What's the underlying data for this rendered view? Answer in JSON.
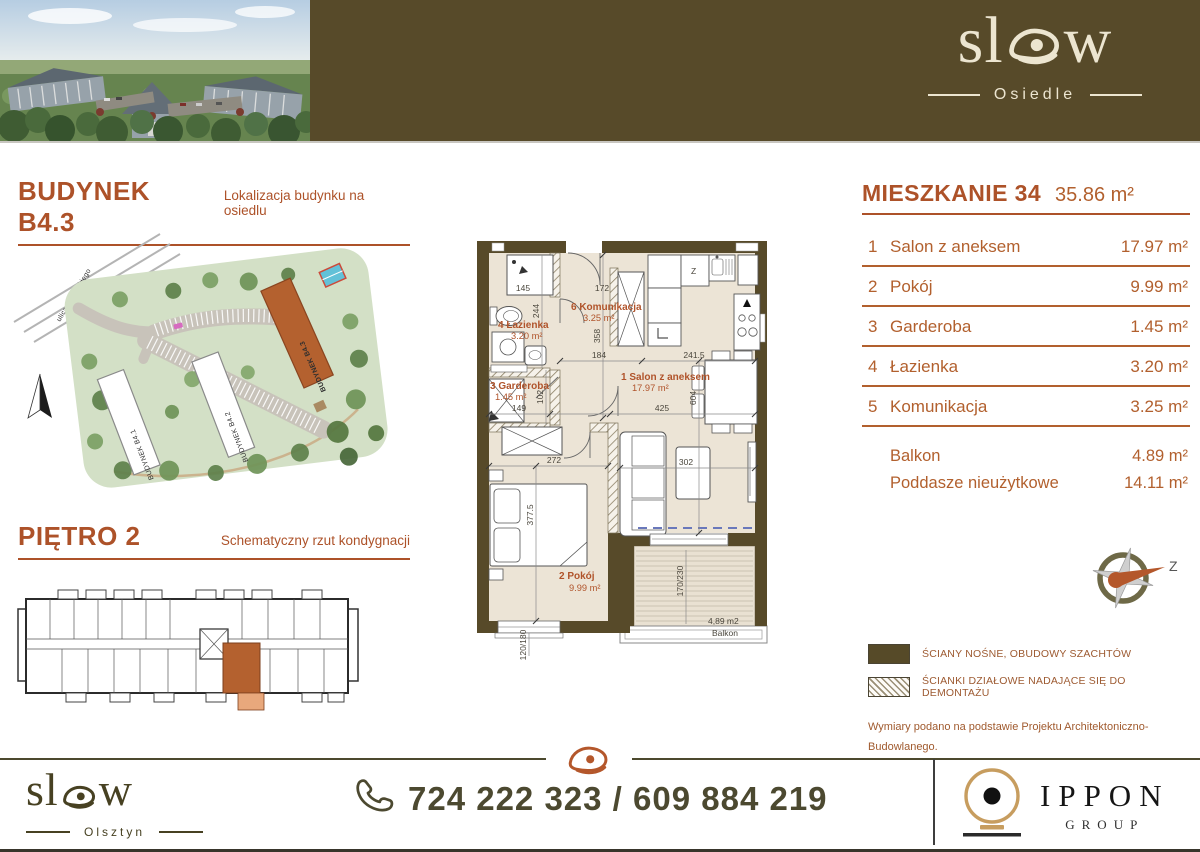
{
  "colors": {
    "accent": "#ad5229",
    "list_text": "#b2602e",
    "dark_band": "#574a29",
    "floor_cream": "#ece4d6",
    "highlight": "#b4612f"
  },
  "header": {
    "logo": {
      "part1": "sl",
      "part2": "w",
      "brand": "slow",
      "sub": "Osiedle"
    }
  },
  "left": {
    "building_section": {
      "title": "BUDYNEK B4.3",
      "subtitle": "Lokalizacja budynku na osiedlu"
    },
    "site_map": {
      "street": "ulica Kordeckiego",
      "b1": "BUDYNEK B4.1",
      "b2": "BUDYNEK B4.2",
      "b3": "BUDYNEK B4.3"
    },
    "floor_section": {
      "title": "PIĘTRO 2",
      "subtitle": "Schematyczny rzut kondygnacji"
    }
  },
  "apartment": {
    "title": "MIESZKANIE 34",
    "total_area": "35.86 m²",
    "rooms": [
      {
        "num": "1",
        "name": "Salon z aneksem",
        "area": "17.97 m²"
      },
      {
        "num": "2",
        "name": "Pokój",
        "area": "9.99 m²"
      },
      {
        "num": "3",
        "name": "Garderoba",
        "area": "1.45 m²"
      },
      {
        "num": "4",
        "name": "Łazienka",
        "area": "3.20 m²"
      },
      {
        "num": "5",
        "name": "Komunikacja",
        "area": "3.25 m²"
      }
    ],
    "extras": [
      {
        "name": "Balkon",
        "area": "4.89 m²"
      },
      {
        "name": "Poddasze nieużytkowe",
        "area": "14.11 m²"
      }
    ]
  },
  "floor_plan": {
    "labels": {
      "bath": {
        "label": "4 Łazienka",
        "area": "3.20 m²"
      },
      "hall": {
        "label": "6 Komunikacja",
        "area": "3.25 m²"
      },
      "gard": {
        "label": "3 Garderoba",
        "area": "1.45 m²"
      },
      "salon": {
        "label": "1 Salon z aneksem",
        "area": "17.97 m²"
      },
      "pokoj": {
        "label": "2 Pokój",
        "area": "9.99 m²"
      }
    },
    "balcony": {
      "area": "4,89 m2",
      "name": "Balkon"
    },
    "appliance_z": "Z",
    "dims": {
      "shower": "145",
      "top_mid": "172",
      "bath_h": "244",
      "hall_h": "358",
      "hall_w": "184",
      "kitchen": "241.5",
      "salon_w": "425",
      "salon_h": "604",
      "gard_w": "149",
      "gard_h": "102",
      "pokoj_w": "272",
      "pokoj_h": "377.5",
      "sofa_gap": "302",
      "window": "120/180",
      "balc": "170/230"
    }
  },
  "compass": {
    "label": "Z"
  },
  "legend": {
    "items": [
      {
        "label": "ŚCIANY NOŚNE, OBUDOWY SZACHTÓW"
      },
      {
        "label": "ŚCIANKI DZIAŁOWE NADAJĄCE SIĘ DO DEMONTAŻU"
      }
    ]
  },
  "disclaimer": {
    "line1": "Wymiary podano na podstawie Projektu Architektoniczno-Budowlanego.",
    "line2": "Powierzchnia użytkowa lokalu liczona zgodnie z normą PN-ISO 9836:2015-12."
  },
  "footer": {
    "logo": {
      "part1": "sl",
      "part2": "w",
      "brand": "slow",
      "sub": "Olsztyn"
    },
    "phone": "724 222 323 / 609 884 219",
    "partner": {
      "name": "IPPON",
      "sub": "GROUP"
    }
  }
}
